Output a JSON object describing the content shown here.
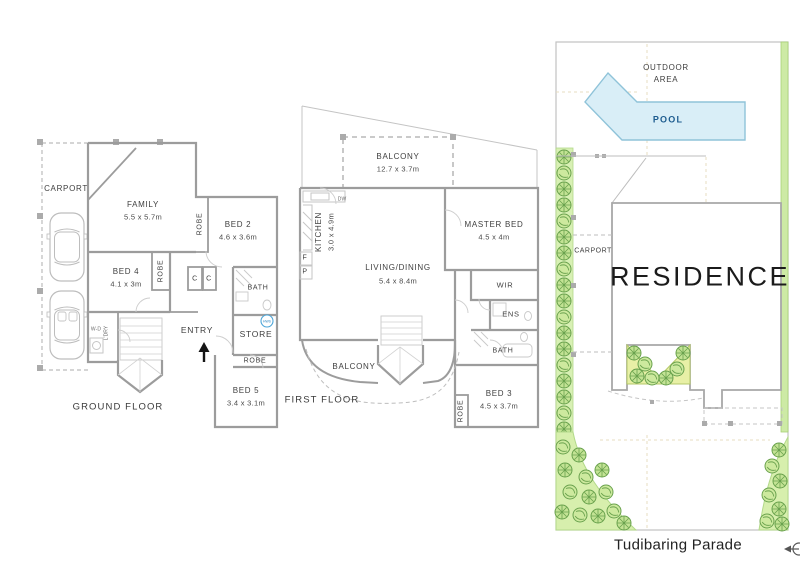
{
  "ground_floor": {
    "floor_label": "GROUND FLOOR",
    "carport": "CARPORT",
    "family": {
      "name": "FAMILY",
      "dims": "5.5 x 5.7m"
    },
    "bed2": {
      "name": "BED 2",
      "dims": "4.6 x 3.6m"
    },
    "bed2_robe": "ROBE",
    "bed4": {
      "name": "BED 4",
      "dims": "4.1 x 3m"
    },
    "bed4_robe": "ROBE",
    "closet1": "C",
    "closet2": "C",
    "bath": "BATH",
    "store": "STORE",
    "hws": "HWS",
    "bed5_robe": "ROBE",
    "bed5": {
      "name": "BED 5",
      "dims": "3.4 x 3.1m"
    },
    "entry": "ENTRY",
    "wd": "W-D",
    "ldry": "L'DRY"
  },
  "first_floor": {
    "floor_label": "FIRST FLOOR",
    "balcony_top": {
      "name": "BALCONY",
      "dims": "12.7 x 3.7m"
    },
    "kitchen": {
      "name": "KITCHEN",
      "dims": "3.0 x 4.9m"
    },
    "dw": "DW",
    "fridge": "F",
    "pantry": "P",
    "living": {
      "name": "LIVING/DINING",
      "dims": "5.4 x 8.4m"
    },
    "master": {
      "name": "MASTER BED",
      "dims": "4.5 x 4m"
    },
    "wir": "WIR",
    "ens": "ENS",
    "bath": "BATH",
    "bed3": {
      "name": "BED 3",
      "dims": "4.5 x 3.7m"
    },
    "bed3_robe": "ROBE",
    "balcony_lower": "BALCONY"
  },
  "site_plan": {
    "outdoor_area_line1": "OUTDOOR",
    "outdoor_area_line2": "AREA",
    "pool": "POOL",
    "carport": "CARPORT",
    "residence": "RESIDENCE",
    "street": "Tudibaring Parade"
  },
  "icons": {
    "entry_direction_arrow": "up-arrow",
    "north_compass": "left-arrow-compass",
    "hot_water_system": "hws-circle",
    "car_top_view": "car-outline",
    "tree": "tree-symbol"
  },
  "colors": {
    "wall_gray": "#9C9C9C",
    "pool_fill": "#D9EEF7",
    "pool_border": "#8FC3D9",
    "pool_text": "#1D5C8F",
    "landscape_strip": "#CDEAA5",
    "garden_fill": "#D7EFAD",
    "courtyard_fill": "#E8F0A6",
    "tree_green": "#6AA24E",
    "hws_blue": "#4DA6D9"
  }
}
